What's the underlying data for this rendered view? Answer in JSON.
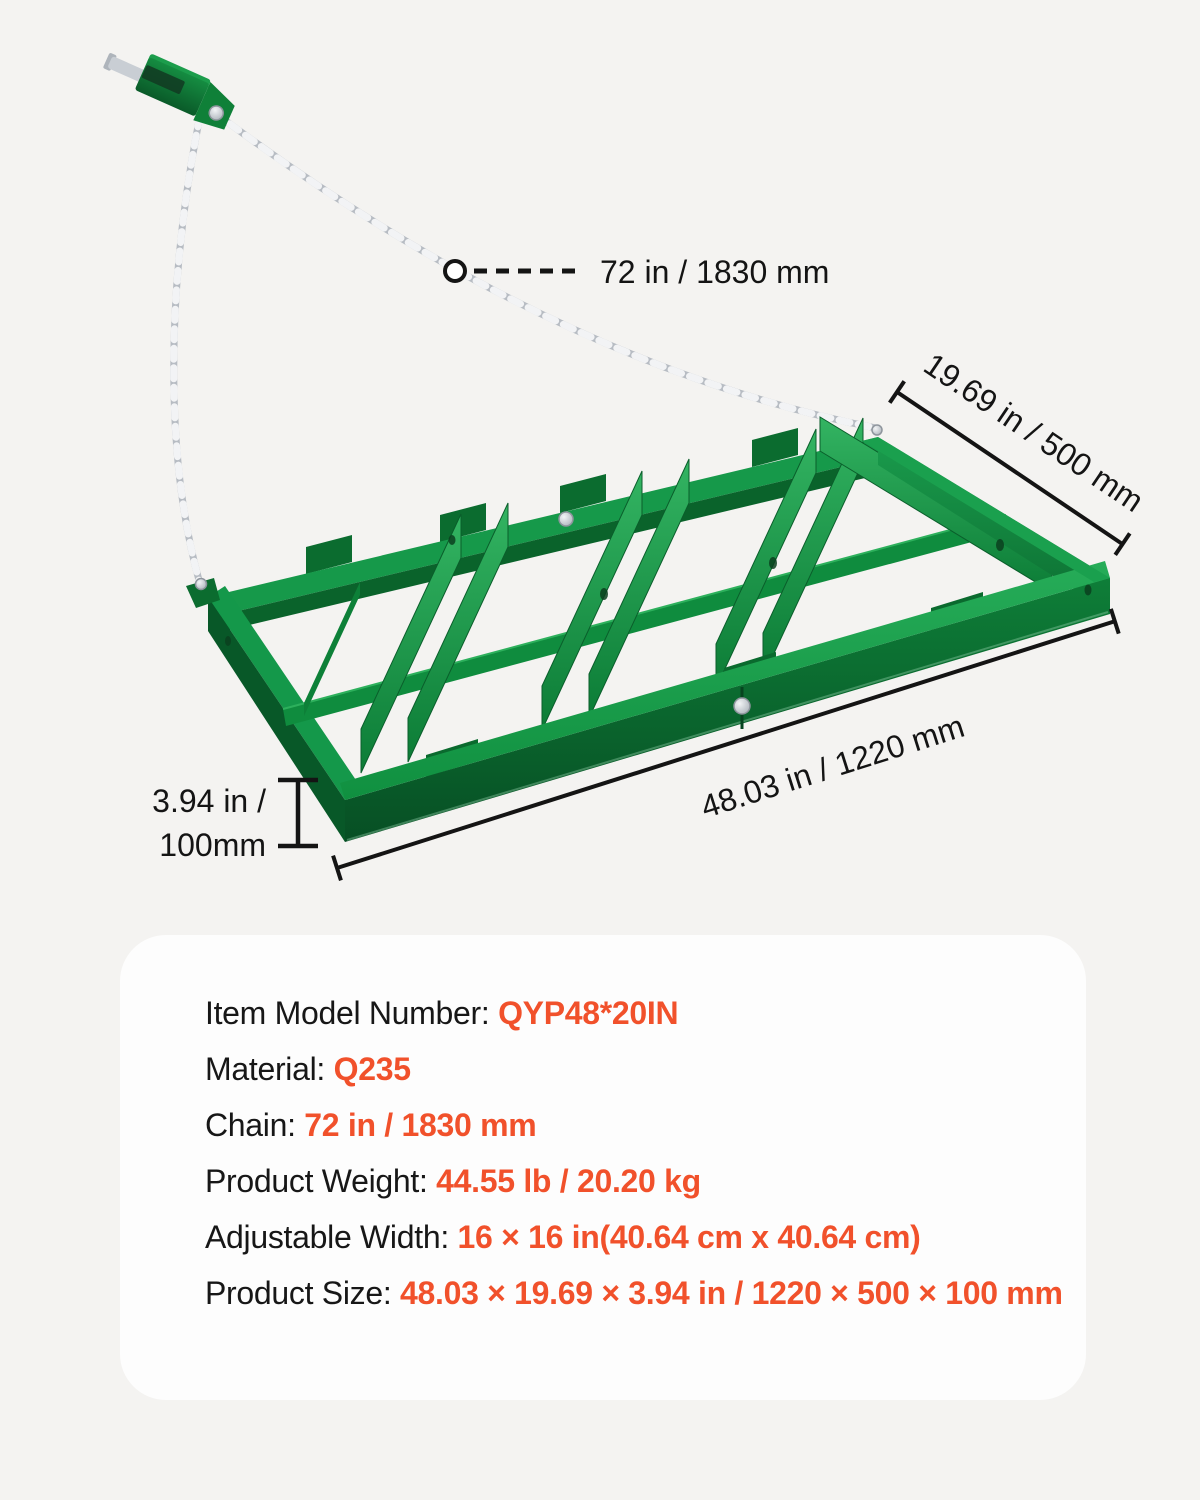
{
  "page": {
    "background": "#F4F3F1"
  },
  "colors": {
    "accent_orange": "#F1512B",
    "frame_green": "#128B41",
    "annotation_black": "#141414",
    "card_background": "#FDFDFD",
    "chain_silver": "#C9CED4"
  },
  "diagram": {
    "chain_length_label": "72 in / 1830 mm",
    "width_label": "19.69 in / 500 mm",
    "length_label": "48.03 in / 1220 mm",
    "height_label_line1": "3.94 in /",
    "height_label_line2": "100mm"
  },
  "spec_card": {
    "rows": [
      {
        "label": "Item Model Number: ",
        "value": "QYP48*20IN"
      },
      {
        "label": "Material: ",
        "value": "Q235"
      },
      {
        "label": "Chain: ",
        "value": "72 in / 1830 mm"
      },
      {
        "label": "Product Weight: ",
        "value": "44.55 lb / 20.20 kg"
      },
      {
        "label": "Adjustable Width: ",
        "value": "16 × 16 in(40.64 cm x 40.64 cm)"
      },
      {
        "label": "Product Size: ",
        "value": "48.03 × 19.69 × 3.94 in / 1220 × 500 × 100 mm"
      }
    ]
  }
}
